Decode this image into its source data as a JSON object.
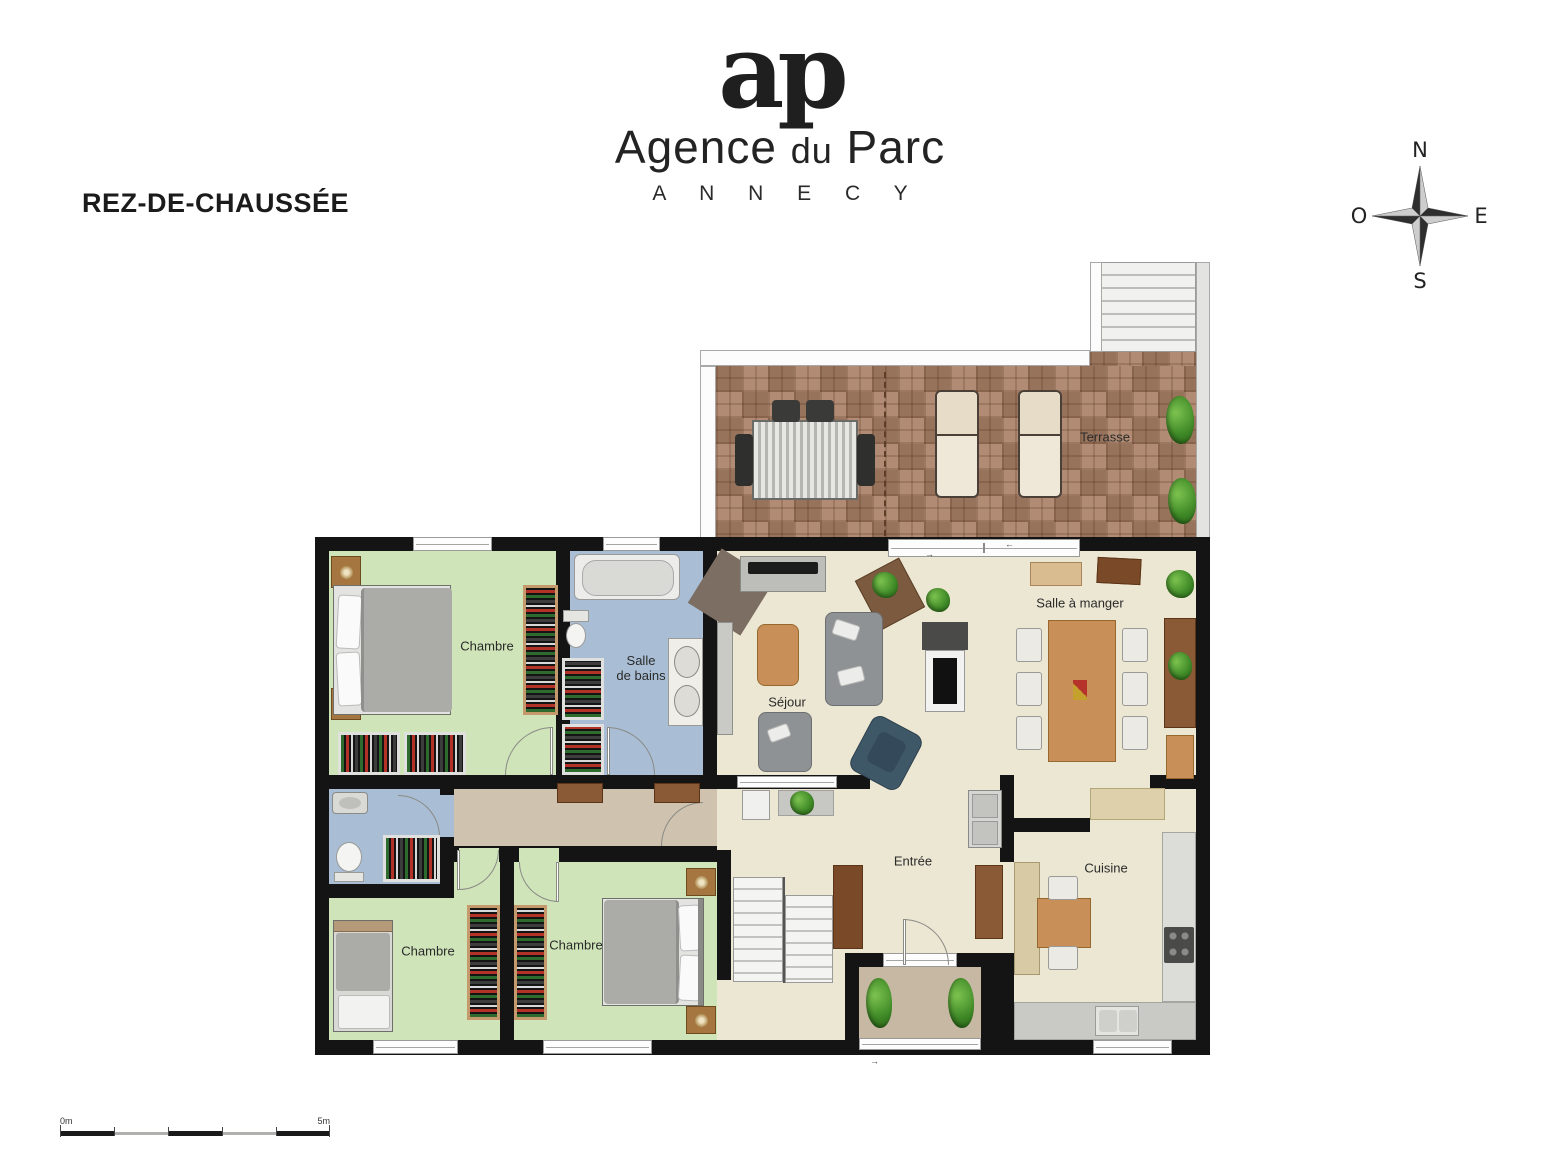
{
  "header": {
    "title": "REZ-DE-CHAUSSÉE",
    "logo": {
      "monogram": "ap",
      "name": [
        "Agence",
        "du",
        "Parc"
      ],
      "city": "A N N E C Y"
    }
  },
  "compass": {
    "north": "N",
    "east": "E",
    "south": "S",
    "west": "O"
  },
  "plan": {
    "rooms": {
      "terrasse": "Terrasse",
      "chambre_top": "Chambre",
      "salle_de_bains_l1": "Salle",
      "salle_de_bains_l2": "de bains",
      "sejour": "Séjour",
      "salle_a_manger": "Salle à manger",
      "entree": "Entrée",
      "cuisine": "Cuisine",
      "chambre_bottom_left": "Chambre",
      "chambre_bottom_mid": "Chambre"
    },
    "slide_arrow_left": "←",
    "slide_arrow_right": "→"
  },
  "scale_bar": {
    "start": "0m",
    "end": "5m"
  },
  "colors": {
    "wall": "#141414",
    "bedroom": "#cfe4b8",
    "bathroom": "#a9bed5",
    "living": "#ece7d2",
    "hallway": "#cfc2ae",
    "porch": "#c6b8a2",
    "terrace": "#a98066",
    "wood": "#c89058"
  }
}
